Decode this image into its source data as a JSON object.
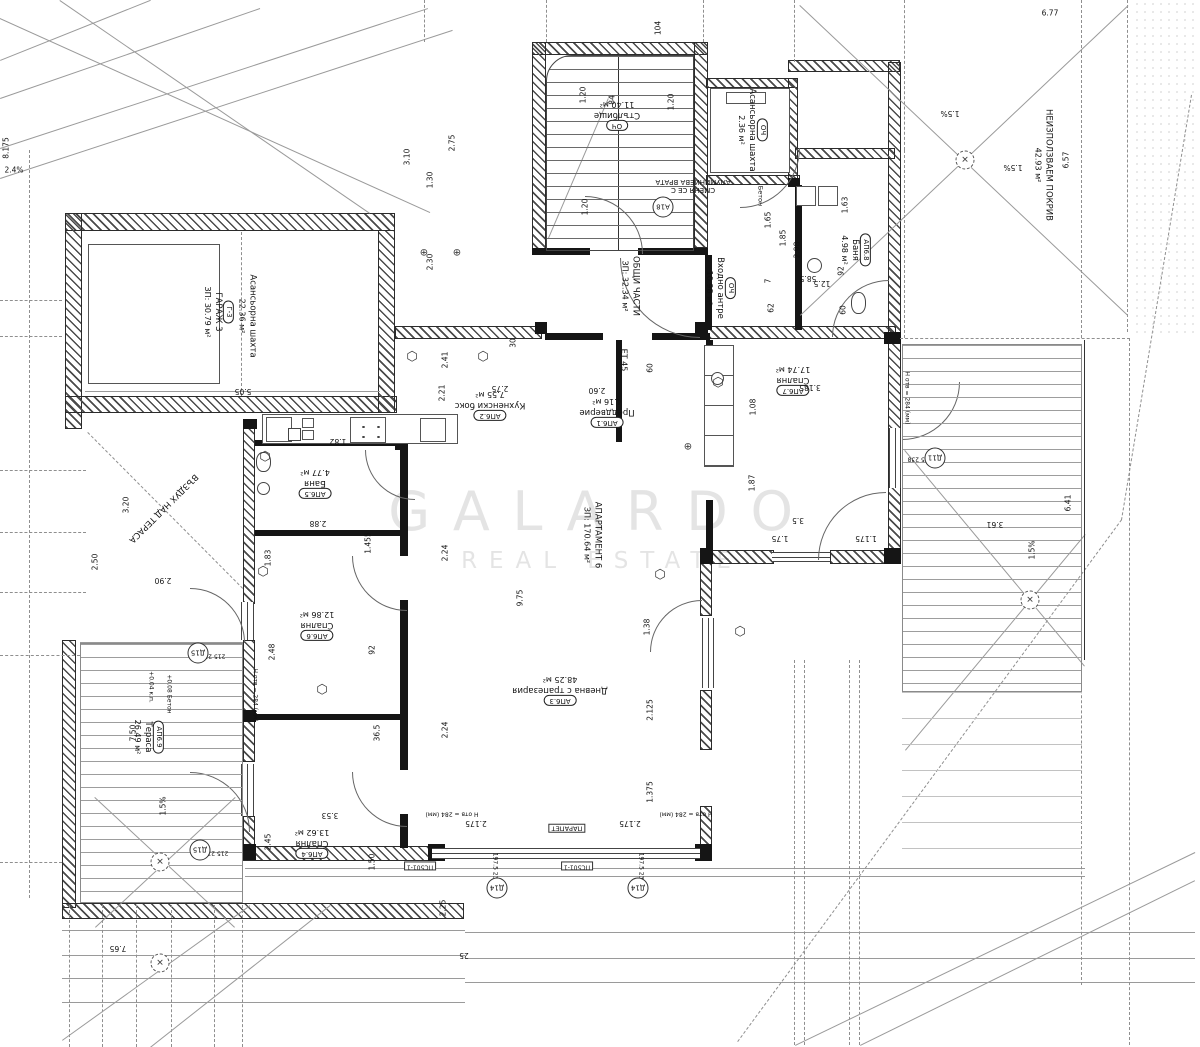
{
  "watermark": {
    "line1": "GALARDO",
    "line2": "REAL ESTATE"
  },
  "rooms": [
    {
      "tag": "ОЧ",
      "name": "Стълбище",
      "area": "11.40 м²",
      "x": 617,
      "y": 115,
      "rot": 180
    },
    {
      "tag": "ОЧ",
      "name": "Асансьорна шахта",
      "area": "2.36 м²",
      "x": 752,
      "y": 130,
      "rot": 90
    },
    {
      "name": "ОБЩИ ЧАСТИ",
      "area": "ЗП: 32.34 м²",
      "x": 630,
      "y": 286,
      "rot": 90
    },
    {
      "tag": "ОЧ",
      "name": "Входно антре",
      "area": "10.98 м²",
      "x": 720,
      "y": 288,
      "rot": 90
    },
    {
      "tag": "АП6.2",
      "name": "Кухненски бокс",
      "area": "7.55 м²",
      "x": 490,
      "y": 405,
      "rot": 180
    },
    {
      "tag": "АП6.1",
      "name": "Преддверие",
      "area": "4.16 м²",
      "x": 607,
      "y": 412,
      "rot": 180
    },
    {
      "tag": "АП6.3",
      "name": "Дневна с трапезария",
      "area": "48.25 м²",
      "x": 560,
      "y": 690,
      "rot": 180
    },
    {
      "name": "АПАРТАМЕНТ 6",
      "area": "ЗП: 170.64 м²",
      "x": 592,
      "y": 535,
      "rot": 90
    },
    {
      "tag": "АП6.7",
      "name": "Спалня",
      "area": "17.74 м²",
      "x": 793,
      "y": 380,
      "rot": 180
    },
    {
      "tag": "АП6.8",
      "name": "Баня",
      "area": "4.98 м²",
      "x": 855,
      "y": 250,
      "rot": 90
    },
    {
      "tag": "АП6.5",
      "name": "Баня",
      "area": "4.77 м²",
      "x": 315,
      "y": 483,
      "rot": 180
    },
    {
      "tag": "АП6.6",
      "name": "Спалня",
      "area": "12.86 м²",
      "x": 317,
      "y": 625,
      "rot": 180
    },
    {
      "tag": "АП6.4",
      "name": "Спалня",
      "area": "13.62 м²",
      "x": 312,
      "y": 843,
      "rot": 180
    },
    {
      "tag": "АП6.9",
      "name": "Тераса",
      "area": "26.49 м²",
      "x": 148,
      "y": 737,
      "rot": 90
    },
    {
      "name": "НЕИЗПОЛЗВАЕМ ПОКРИВ",
      "area": "42.93 м²",
      "x": 1043,
      "y": 165,
      "rot": 90
    },
    {
      "name": "ВЪЗДУХ НАД ТЕРАСА",
      "x": 163,
      "y": 508,
      "rot": 135
    },
    {
      "tag": "Г-3",
      "name": "ГАРАЖ 3",
      "area": "ЗП: 30.79 м²",
      "x": 218,
      "y": 312,
      "rot": 90
    },
    {
      "name": "Асансьорна шахта",
      "area": "22.36 м²",
      "x": 247,
      "y": 316,
      "rot": 90
    }
  ],
  "dims": [
    {
      "t": "2.4%",
      "x": 14,
      "y": 170,
      "o": "h"
    },
    {
      "t": "8.175",
      "x": 6,
      "y": 148,
      "o": "v"
    },
    {
      "t": "3.10",
      "x": 407,
      "y": 157,
      "o": "v"
    },
    {
      "t": "2.75",
      "x": 452,
      "y": 143,
      "o": "v"
    },
    {
      "t": "1.30",
      "x": 430,
      "y": 180,
      "o": "v"
    },
    {
      "t": "2.30",
      "x": 430,
      "y": 262,
      "o": "v"
    },
    {
      "t": "1.20",
      "x": 583,
      "y": 95,
      "o": "v"
    },
    {
      "t": "84",
      "x": 612,
      "y": 100,
      "o": "v"
    },
    {
      "t": "1.20",
      "x": 671,
      "y": 102,
      "o": "v"
    },
    {
      "t": "1.20",
      "x": 585,
      "y": 207,
      "o": "v"
    },
    {
      "t": "104",
      "x": 658,
      "y": 28,
      "o": "v"
    },
    {
      "t": "1.65",
      "x": 768,
      "y": 220,
      "o": "v"
    },
    {
      "t": "1.85",
      "x": 783,
      "y": 238,
      "o": "v"
    },
    {
      "t": "2.98",
      "x": 797,
      "y": 250,
      "o": "v"
    },
    {
      "t": "1.63",
      "x": 845,
      "y": 205,
      "o": "v"
    },
    {
      "t": "6.77",
      "x": 1050,
      "y": 13,
      "o": "h"
    },
    {
      "t": "6.57",
      "x": 1066,
      "y": 160,
      "o": "v"
    },
    {
      "t": "5.05",
      "x": 243,
      "y": 391,
      "o": "r"
    },
    {
      "t": "3.20",
      "x": 126,
      "y": 505,
      "o": "v"
    },
    {
      "t": "2.50",
      "x": 95,
      "y": 562,
      "o": "v"
    },
    {
      "t": "2.90",
      "x": 163,
      "y": 580,
      "o": "r"
    },
    {
      "t": "1.82",
      "x": 338,
      "y": 441,
      "o": "r"
    },
    {
      "t": "2.41",
      "x": 445,
      "y": 360,
      "o": "v"
    },
    {
      "t": "2.21",
      "x": 442,
      "y": 393,
      "o": "v"
    },
    {
      "t": "2.75",
      "x": 500,
      "y": 388,
      "o": "r"
    },
    {
      "t": "2.60",
      "x": 597,
      "y": 390,
      "o": "r"
    },
    {
      "t": "30",
      "x": 513,
      "y": 343,
      "o": "v"
    },
    {
      "t": "60",
      "x": 650,
      "y": 368,
      "o": "v"
    },
    {
      "t": "2.88",
      "x": 318,
      "y": 523,
      "o": "r"
    },
    {
      "t": "1.83",
      "x": 268,
      "y": 558,
      "o": "v"
    },
    {
      "t": "1.455",
      "x": 368,
      "y": 543,
      "o": "v"
    },
    {
      "t": "2.24",
      "x": 445,
      "y": 553,
      "o": "v"
    },
    {
      "t": "9.75",
      "x": 520,
      "y": 598,
      "o": "v"
    },
    {
      "t": "2.24",
      "x": 445,
      "y": 730,
      "o": "v"
    },
    {
      "t": "1.38",
      "x": 647,
      "y": 627,
      "o": "v"
    },
    {
      "t": "2.125",
      "x": 650,
      "y": 710,
      "o": "v"
    },
    {
      "t": "1.375",
      "x": 650,
      "y": 792,
      "o": "v"
    },
    {
      "t": "92",
      "x": 372,
      "y": 650,
      "o": "v"
    },
    {
      "t": "36.5",
      "x": 377,
      "y": 733,
      "o": "v"
    },
    {
      "t": "3.53",
      "x": 330,
      "y": 815,
      "o": "r"
    },
    {
      "t": "2.45",
      "x": 268,
      "y": 842,
      "o": "v"
    },
    {
      "t": "2.48",
      "x": 272,
      "y": 652,
      "o": "v"
    },
    {
      "t": "1.50",
      "x": 372,
      "y": 862,
      "o": "v"
    },
    {
      "t": "7.50",
      "x": 133,
      "y": 733,
      "o": "v"
    },
    {
      "t": "7.65",
      "x": 118,
      "y": 948,
      "o": "r"
    },
    {
      "t": "2.25",
      "x": 443,
      "y": 908,
      "o": "v"
    },
    {
      "t": "25",
      "x": 464,
      "y": 955,
      "o": "r"
    },
    {
      "t": "2.175",
      "x": 476,
      "y": 823,
      "o": "r"
    },
    {
      "t": "2.175",
      "x": 630,
      "y": 823,
      "o": "r"
    },
    {
      "t": "3.185",
      "x": 810,
      "y": 387,
      "o": "r"
    },
    {
      "t": "1.08",
      "x": 753,
      "y": 407,
      "o": "v"
    },
    {
      "t": "1.87",
      "x": 752,
      "y": 483,
      "o": "v"
    },
    {
      "t": "3.5",
      "x": 798,
      "y": 520,
      "o": "r"
    },
    {
      "t": "1.75",
      "x": 780,
      "y": 538,
      "o": "r"
    },
    {
      "t": "1.175",
      "x": 866,
      "y": 538,
      "o": "r"
    },
    {
      "t": "62",
      "x": 771,
      "y": 308,
      "o": "v"
    },
    {
      "t": "7",
      "x": 768,
      "y": 281,
      "o": "v"
    },
    {
      "t": "58.5",
      "x": 808,
      "y": 278,
      "o": "r"
    },
    {
      "t": "12.5",
      "x": 822,
      "y": 283,
      "o": "r"
    },
    {
      "t": "92",
      "x": 841,
      "y": 271,
      "o": "v"
    },
    {
      "t": "60",
      "x": 843,
      "y": 310,
      "o": "v"
    },
    {
      "t": "3.61",
      "x": 995,
      "y": 524,
      "o": "r"
    },
    {
      "t": "6.41",
      "x": 1068,
      "y": 503,
      "o": "v"
    },
    {
      "t": "1.5%",
      "x": 950,
      "y": 113,
      "o": "r"
    },
    {
      "t": "1.5%",
      "x": 1013,
      "y": 167,
      "o": "r"
    },
    {
      "t": "1.5%",
      "x": 1032,
      "y": 550,
      "o": "v"
    },
    {
      "t": "1.5%",
      "x": 163,
      "y": 806,
      "o": "v"
    }
  ],
  "annotations": [
    {
      "t": "СМЕНЯ СЕ С\nАЛУМИНИЕВА ВРАТА",
      "x": 693,
      "y": 186,
      "o": "r"
    },
    {
      "t": "ЕТ 45",
      "x": 624,
      "y": 360,
      "o": "vr",
      "fs": 8
    },
    {
      "t": "Бетон",
      "x": 760,
      "y": 196,
      "o": "vr",
      "fs": 6.5
    },
    {
      "t": "+0.04 к.п.",
      "x": 150,
      "y": 687,
      "o": "vr",
      "fs": 6
    },
    {
      "t": "+0.08 Бетон",
      "x": 168,
      "y": 694,
      "o": "vr",
      "fs": 6
    },
    {
      "t": "ПАРАПЕТ",
      "x": 567,
      "y": 828,
      "o": "r",
      "fs": 6.5,
      "box": true
    },
    {
      "t": "ПС501-1",
      "x": 420,
      "y": 866,
      "o": "r",
      "fs": 6,
      "box": true
    },
    {
      "t": "ПС501-1",
      "x": 577,
      "y": 866,
      "o": "r",
      "fs": 6,
      "box": true
    },
    {
      "t": "197.5  238",
      "x": 494,
      "y": 868,
      "o": "vr",
      "fs": 6
    },
    {
      "t": "197.5  238",
      "x": 640,
      "y": 868,
      "o": "vr",
      "fs": 6
    },
    {
      "t": "215  238",
      "x": 213,
      "y": 655,
      "o": "r",
      "fs": 6
    },
    {
      "t": "215  238",
      "x": 216,
      "y": 852,
      "o": "r",
      "fs": 6
    },
    {
      "t": "465  238",
      "x": 920,
      "y": 458,
      "o": "r",
      "fs": 6
    },
    {
      "t": "Н отв = 284 (мм)",
      "x": 254,
      "y": 695,
      "o": "vr",
      "fs": 6
    },
    {
      "t": "Н отв = 284 (мм)",
      "x": 906,
      "y": 398,
      "o": "vr",
      "fs": 6
    },
    {
      "t": "Н отв = 284 (мм)",
      "x": 452,
      "y": 813,
      "o": "r",
      "fs": 6
    },
    {
      "t": "Н отв = 284 (мм)",
      "x": 686,
      "y": 813,
      "o": "r",
      "fs": 6
    }
  ],
  "marks": [
    {
      "t": "Д15",
      "x": 198,
      "y": 653
    },
    {
      "t": "Д15",
      "x": 200,
      "y": 850
    },
    {
      "t": "Д14",
      "x": 497,
      "y": 888
    },
    {
      "t": "Д14",
      "x": 638,
      "y": 888
    },
    {
      "t": "Д11",
      "x": 935,
      "y": 458
    },
    {
      "t": "А18",
      "x": 663,
      "y": 207
    }
  ]
}
